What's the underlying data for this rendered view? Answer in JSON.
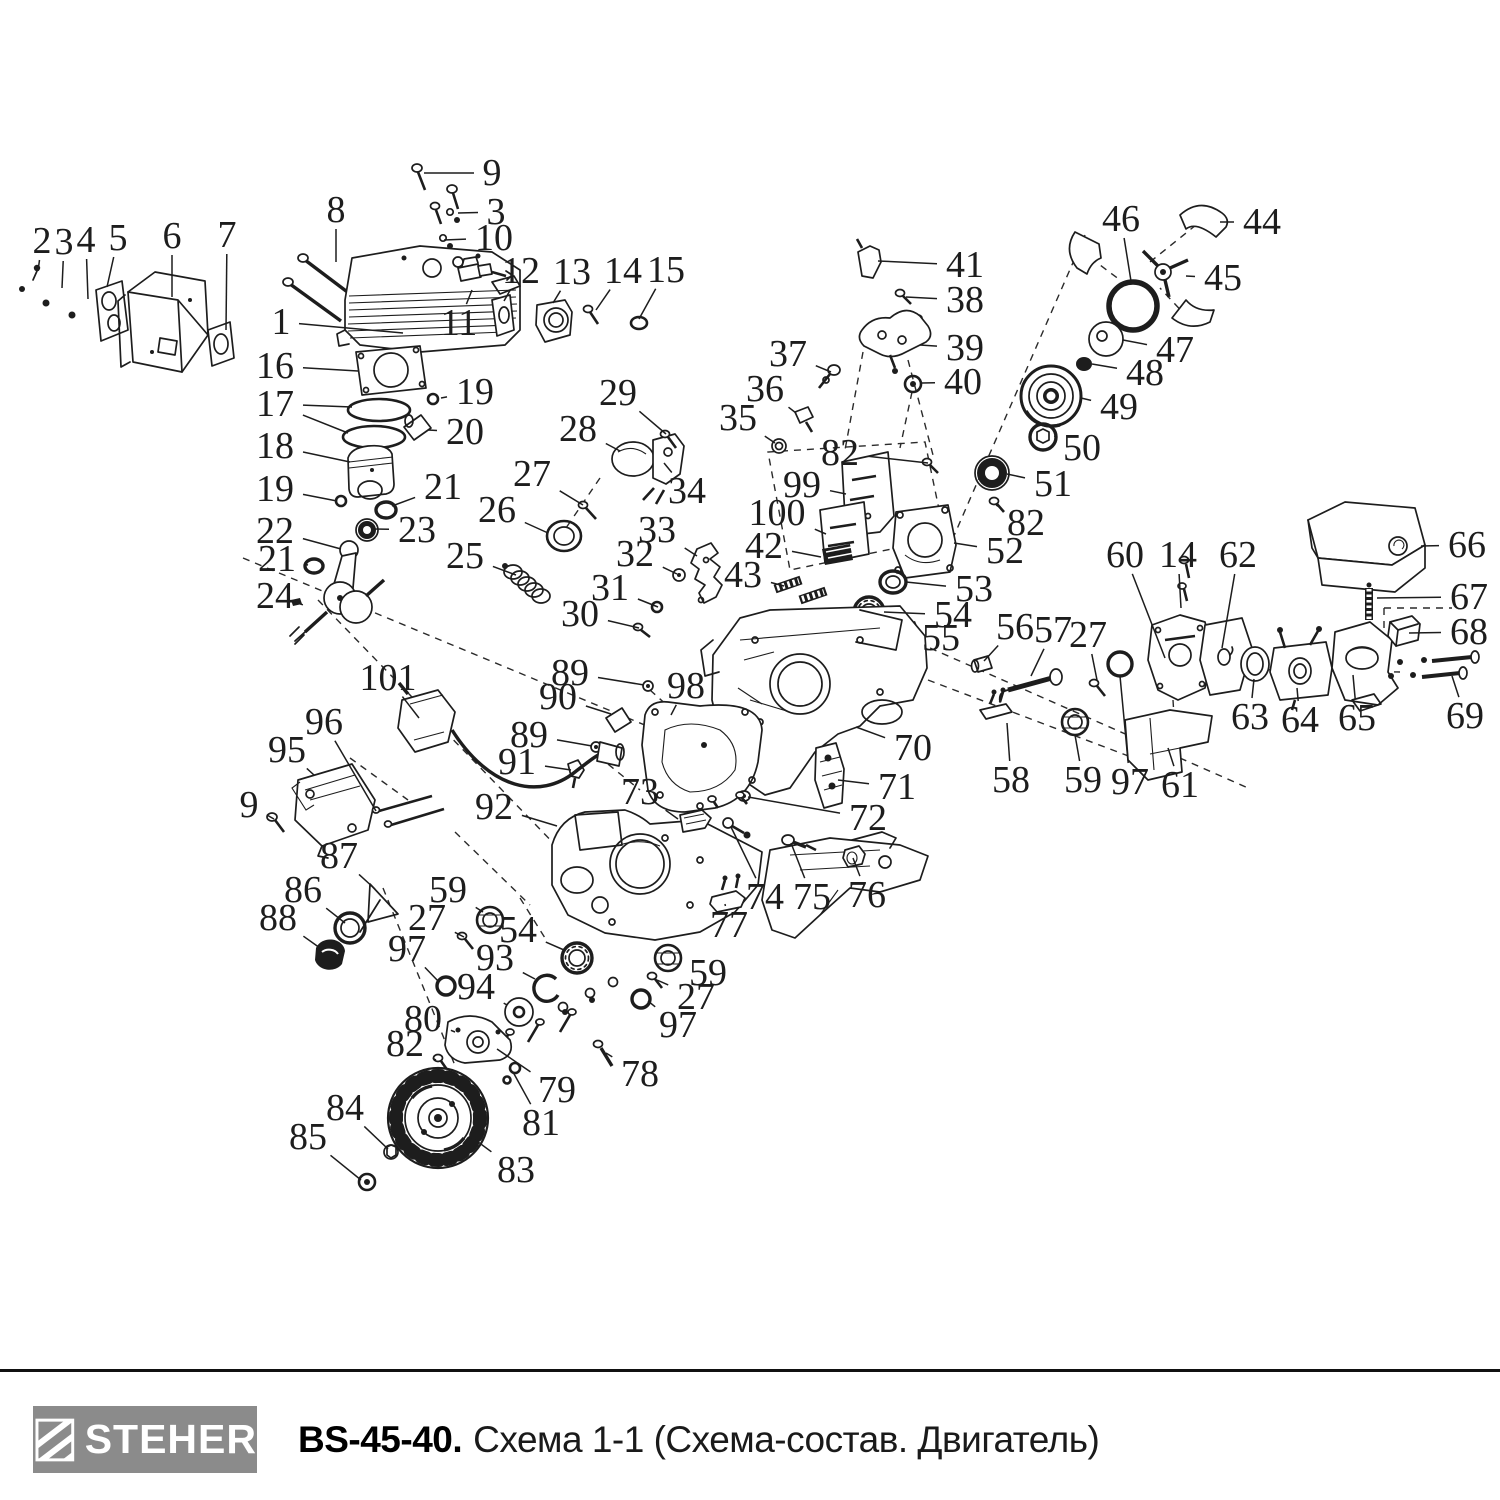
{
  "footer": {
    "brand": "STEHER",
    "model": "BS-45-40.",
    "title": "Схема 1-1 (Схема-состав. Двигатель)"
  },
  "colors": {
    "ink": "#1d1d1d",
    "dash": "#2a2a2a",
    "logo_bg": "#8b8b8b",
    "logo_text": "#ffffff"
  },
  "callouts": [
    {
      "n": "2",
      "x": 42,
      "y": 241,
      "t": [
        [
          38,
          271
        ]
      ]
    },
    {
      "n": "3",
      "x": 64,
      "y": 242,
      "t": [
        [
          62,
          288
        ]
      ]
    },
    {
      "n": "4",
      "x": 86,
      "y": 240,
      "t": [
        [
          88,
          299
        ]
      ]
    },
    {
      "n": "5",
      "x": 118,
      "y": 238,
      "t": [
        [
          107,
          287
        ]
      ]
    },
    {
      "n": "6",
      "x": 172,
      "y": 236,
      "t": [
        [
          172,
          297
        ]
      ]
    },
    {
      "n": "7",
      "x": 227,
      "y": 235,
      "t": [
        [
          226,
          330
        ]
      ]
    },
    {
      "n": "8",
      "x": 336,
      "y": 210,
      "t": [
        [
          336,
          262
        ]
      ]
    },
    {
      "n": "9",
      "x": 492,
      "y": 173,
      "t": [
        [
          424,
          173
        ]
      ]
    },
    {
      "n": "3",
      "x": 496,
      "y": 212,
      "t": [
        [
          458,
          213
        ]
      ]
    },
    {
      "n": "10",
      "x": 494,
      "y": 238,
      "t": [
        [
          444,
          240
        ]
      ]
    },
    {
      "n": "1",
      "x": 281,
      "y": 322,
      "t": [
        [
          403,
          333
        ]
      ]
    },
    {
      "n": "11",
      "x": 459,
      "y": 323,
      "t": [
        [
          472,
          290
        ]
      ]
    },
    {
      "n": "12",
      "x": 521,
      "y": 271,
      "t": [
        [
          504,
          301
        ]
      ]
    },
    {
      "n": "13",
      "x": 572,
      "y": 272,
      "t": [
        [
          553,
          303
        ]
      ]
    },
    {
      "n": "14",
      "x": 623,
      "y": 271,
      "t": [
        [
          596,
          310
        ]
      ]
    },
    {
      "n": "15",
      "x": 666,
      "y": 270,
      "t": [
        [
          639,
          319
        ]
      ]
    },
    {
      "n": "16",
      "x": 275,
      "y": 366,
      "t": [
        [
          358,
          371
        ]
      ]
    },
    {
      "n": "17",
      "x": 275,
      "y": 404,
      "t": [
        [
          352,
          407
        ],
        [
          348,
          433
        ]
      ]
    },
    {
      "n": "19",
      "x": 475,
      "y": 392,
      "t": [
        [
          441,
          398
        ]
      ]
    },
    {
      "n": "20",
      "x": 465,
      "y": 432,
      "t": [
        [
          428,
          430
        ]
      ]
    },
    {
      "n": "18",
      "x": 275,
      "y": 446,
      "t": [
        [
          350,
          462
        ]
      ]
    },
    {
      "n": "19",
      "x": 275,
      "y": 489,
      "t": [
        [
          337,
          501
        ]
      ]
    },
    {
      "n": "21",
      "x": 443,
      "y": 487,
      "t": [
        [
          392,
          506
        ]
      ]
    },
    {
      "n": "22",
      "x": 275,
      "y": 531,
      "t": [
        [
          341,
          549
        ]
      ]
    },
    {
      "n": "23",
      "x": 417,
      "y": 530,
      "t": [
        [
          374,
          529
        ]
      ]
    },
    {
      "n": "21",
      "x": 277,
      "y": 559,
      "t": [
        [
          308,
          565
        ]
      ]
    },
    {
      "n": "24",
      "x": 275,
      "y": 596,
      "t": [
        [
          294,
          602
        ]
      ]
    },
    {
      "n": "25",
      "x": 465,
      "y": 556,
      "t": [
        [
          516,
          575
        ]
      ]
    },
    {
      "n": "26",
      "x": 497,
      "y": 510,
      "t": [
        [
          548,
          533
        ]
      ]
    },
    {
      "n": "27",
      "x": 532,
      "y": 474,
      "t": [
        [
          583,
          505
        ]
      ]
    },
    {
      "n": "28",
      "x": 578,
      "y": 429,
      "t": [
        [
          620,
          451
        ]
      ]
    },
    {
      "n": "29",
      "x": 618,
      "y": 393,
      "t": [
        [
          666,
          434
        ]
      ]
    },
    {
      "n": "30",
      "x": 580,
      "y": 614,
      "t": [
        [
          639,
          628
        ]
      ]
    },
    {
      "n": "31",
      "x": 610,
      "y": 588,
      "t": [
        [
          658,
          607
        ]
      ]
    },
    {
      "n": "32",
      "x": 635,
      "y": 554,
      "t": [
        [
          677,
          574
        ]
      ]
    },
    {
      "n": "33",
      "x": 657,
      "y": 530,
      "t": [
        [
          697,
          556
        ]
      ]
    },
    {
      "n": "34",
      "x": 687,
      "y": 491,
      "t": [
        [
          664,
          463
        ]
      ]
    },
    {
      "n": "35",
      "x": 738,
      "y": 418,
      "t": [
        [
          775,
          443
        ]
      ]
    },
    {
      "n": "36",
      "x": 765,
      "y": 389,
      "t": [
        [
          796,
          413
        ]
      ]
    },
    {
      "n": "37",
      "x": 788,
      "y": 354,
      "t": [
        [
          831,
          372
        ]
      ]
    },
    {
      "n": "38",
      "x": 965,
      "y": 300,
      "t": [
        [
          906,
          297
        ]
      ]
    },
    {
      "n": "39",
      "x": 965,
      "y": 348,
      "t": [
        [
          920,
          345
        ]
      ]
    },
    {
      "n": "40",
      "x": 963,
      "y": 382,
      "t": [
        [
          922,
          383
        ]
      ]
    },
    {
      "n": "41",
      "x": 965,
      "y": 265,
      "t": [
        [
          878,
          261
        ]
      ]
    },
    {
      "n": "42",
      "x": 764,
      "y": 546,
      "t": [
        [
          821,
          557
        ]
      ]
    },
    {
      "n": "43",
      "x": 743,
      "y": 575,
      "t": [
        [
          784,
          586
        ]
      ]
    },
    {
      "n": "44",
      "x": 1262,
      "y": 222,
      "t": [
        [
          1220,
          222
        ]
      ]
    },
    {
      "n": "45",
      "x": 1223,
      "y": 278,
      "t": [
        [
          1186,
          276
        ]
      ]
    },
    {
      "n": "46",
      "x": 1121,
      "y": 219,
      "t": [
        [
          1131,
          281
        ]
      ]
    },
    {
      "n": "47",
      "x": 1175,
      "y": 350,
      "t": [
        [
          1123,
          340
        ]
      ]
    },
    {
      "n": "48",
      "x": 1145,
      "y": 373,
      "t": [
        [
          1092,
          364
        ]
      ]
    },
    {
      "n": "49",
      "x": 1119,
      "y": 407,
      "t": [
        [
          1081,
          398
        ]
      ]
    },
    {
      "n": "50",
      "x": 1082,
      "y": 448,
      "t": [
        [
          1056,
          437
        ]
      ]
    },
    {
      "n": "51",
      "x": 1053,
      "y": 484,
      "t": [
        [
          1007,
          474
        ]
      ]
    },
    {
      "n": "52",
      "x": 1005,
      "y": 551,
      "t": [
        [
          954,
          543
        ]
      ]
    },
    {
      "n": "53",
      "x": 974,
      "y": 589,
      "t": [
        [
          906,
          582
        ]
      ]
    },
    {
      "n": "54",
      "x": 953,
      "y": 615,
      "t": [
        [
          884,
          612
        ]
      ]
    },
    {
      "n": "55",
      "x": 941,
      "y": 638,
      "t": [
        [
          913,
          632
        ]
      ]
    },
    {
      "n": "56",
      "x": 1015,
      "y": 627,
      "t": [
        [
          984,
          661
        ]
      ]
    },
    {
      "n": "57",
      "x": 1053,
      "y": 630,
      "t": [
        [
          1031,
          676
        ]
      ]
    },
    {
      "n": "27",
      "x": 1088,
      "y": 635,
      "t": [
        [
          1097,
          680
        ]
      ]
    },
    {
      "n": "58",
      "x": 1011,
      "y": 780,
      "t": [
        [
          1007,
          723
        ]
      ]
    },
    {
      "n": "59",
      "x": 1083,
      "y": 780,
      "t": [
        [
          1075,
          735
        ]
      ]
    },
    {
      "n": "97",
      "x": 1130,
      "y": 782,
      "t": [
        [
          1120,
          676
        ]
      ]
    },
    {
      "n": "60",
      "x": 1125,
      "y": 555,
      "t": [
        [
          1165,
          658
        ]
      ]
    },
    {
      "n": "14",
      "x": 1178,
      "y": 555,
      "t": [
        [
          1181,
          608
        ]
      ]
    },
    {
      "n": "62",
      "x": 1238,
      "y": 555,
      "t": [
        [
          1222,
          648
        ]
      ]
    },
    {
      "n": "61",
      "x": 1180,
      "y": 785,
      "t": [
        [
          1168,
          748
        ]
      ]
    },
    {
      "n": "63",
      "x": 1250,
      "y": 717,
      "t": [
        [
          1254,
          679
        ]
      ]
    },
    {
      "n": "64",
      "x": 1300,
      "y": 720,
      "t": [
        [
          1297,
          688
        ]
      ]
    },
    {
      "n": "65",
      "x": 1357,
      "y": 718,
      "t": [
        [
          1353,
          675
        ]
      ]
    },
    {
      "n": "66",
      "x": 1467,
      "y": 545,
      "t": [
        [
          1421,
          546
        ]
      ]
    },
    {
      "n": "67",
      "x": 1469,
      "y": 597,
      "t": [
        [
          1377,
          598
        ]
      ]
    },
    {
      "n": "68",
      "x": 1469,
      "y": 632,
      "t": [
        [
          1409,
          633
        ]
      ]
    },
    {
      "n": "69",
      "x": 1465,
      "y": 716,
      "t": [
        [
          1452,
          676
        ]
      ]
    },
    {
      "n": "70",
      "x": 913,
      "y": 748,
      "t": [
        [
          856,
          727
        ]
      ]
    },
    {
      "n": "71",
      "x": 897,
      "y": 787,
      "t": [
        [
          838,
          780
        ]
      ]
    },
    {
      "n": "72",
      "x": 868,
      "y": 818,
      "t": [
        [
          748,
          797
        ]
      ]
    },
    {
      "n": "73",
      "x": 640,
      "y": 792,
      "t": [
        [
          678,
          819
        ]
      ]
    },
    {
      "n": "74",
      "x": 765,
      "y": 897,
      "t": [
        [
          731,
          827
        ]
      ]
    },
    {
      "n": "75",
      "x": 812,
      "y": 897,
      "t": [
        [
          791,
          843
        ]
      ]
    },
    {
      "n": "76",
      "x": 867,
      "y": 895,
      "t": [
        [
          853,
          858
        ]
      ]
    },
    {
      "n": "77",
      "x": 729,
      "y": 925,
      "t": [
        [
          725,
          904
        ]
      ]
    },
    {
      "n": "78",
      "x": 640,
      "y": 1074,
      "t": [
        [
          606,
          1053
        ]
      ]
    },
    {
      "n": "79",
      "x": 557,
      "y": 1090,
      "t": [
        [
          497,
          1049
        ]
      ]
    },
    {
      "n": "80",
      "x": 423,
      "y": 1019,
      "t": [
        [
          455,
          1032
        ]
      ]
    },
    {
      "n": "81",
      "x": 541,
      "y": 1123,
      "t": [
        [
          513,
          1072
        ]
      ]
    },
    {
      "n": "82",
      "x": 405,
      "y": 1044,
      "t": [
        [
          436,
          1060
        ]
      ]
    },
    {
      "n": "83",
      "x": 516,
      "y": 1170,
      "t": [
        [
          470,
          1136
        ]
      ]
    },
    {
      "n": "84",
      "x": 345,
      "y": 1108,
      "t": [
        [
          388,
          1149
        ]
      ]
    },
    {
      "n": "85",
      "x": 308,
      "y": 1137,
      "t": [
        [
          361,
          1180
        ]
      ]
    },
    {
      "n": "86",
      "x": 303,
      "y": 890,
      "t": [
        [
          345,
          923
        ]
      ]
    },
    {
      "n": "87",
      "x": 339,
      "y": 856,
      "t": [
        [
          375,
          889
        ]
      ]
    },
    {
      "n": "88",
      "x": 278,
      "y": 918,
      "t": [
        [
          320,
          948
        ]
      ]
    },
    {
      "n": "89",
      "x": 570,
      "y": 673,
      "t": [
        [
          644,
          685
        ]
      ]
    },
    {
      "n": "90",
      "x": 558,
      "y": 697,
      "t": [
        [
          611,
          714
        ]
      ]
    },
    {
      "n": "89",
      "x": 529,
      "y": 735,
      "t": [
        [
          592,
          746
        ]
      ]
    },
    {
      "n": "91",
      "x": 517,
      "y": 762,
      "t": [
        [
          571,
          770
        ]
      ]
    },
    {
      "n": "92",
      "x": 494,
      "y": 807,
      "t": [
        [
          557,
          826
        ]
      ]
    },
    {
      "n": "93",
      "x": 495,
      "y": 958,
      "t": [
        [
          535,
          979
        ]
      ]
    },
    {
      "n": "94",
      "x": 476,
      "y": 987,
      "t": [
        [
          507,
          1005
        ]
      ]
    },
    {
      "n": "95",
      "x": 287,
      "y": 750,
      "t": [
        [
          314,
          775
        ]
      ]
    },
    {
      "n": "96",
      "x": 324,
      "y": 722,
      "t": [
        [
          376,
          811
        ]
      ]
    },
    {
      "n": "97",
      "x": 407,
      "y": 949,
      "t": [
        [
          439,
          982
        ]
      ]
    },
    {
      "n": "98",
      "x": 686,
      "y": 686,
      "t": [
        [
          671,
          715
        ]
      ]
    },
    {
      "n": "99",
      "x": 802,
      "y": 485,
      "t": [
        [
          846,
          494
        ]
      ]
    },
    {
      "n": "100",
      "x": 777,
      "y": 513,
      "t": [
        [
          826,
          534
        ]
      ]
    },
    {
      "n": "101",
      "x": 388,
      "y": 678,
      "t": [
        [
          419,
          718
        ]
      ]
    },
    {
      "n": "9",
      "x": 249,
      "y": 805,
      "t": [
        [
          274,
          819
        ]
      ]
    },
    {
      "n": "27",
      "x": 427,
      "y": 918,
      "t": [
        [
          464,
          937
        ]
      ]
    },
    {
      "n": "54",
      "x": 518,
      "y": 930,
      "t": [
        [
          564,
          950
        ]
      ]
    },
    {
      "n": "59",
      "x": 448,
      "y": 890,
      "t": [
        [
          483,
          912
        ]
      ]
    },
    {
      "n": "27",
      "x": 696,
      "y": 997,
      "t": [
        [
          657,
          980
        ]
      ]
    },
    {
      "n": "59",
      "x": 708,
      "y": 973,
      "t": [
        [
          681,
          960
        ]
      ]
    },
    {
      "n": "97",
      "x": 678,
      "y": 1025,
      "t": [
        [
          648,
          1001
        ]
      ]
    },
    {
      "n": "82",
      "x": 840,
      "y": 453,
      "t": [
        [
          928,
          463
        ]
      ]
    },
    {
      "n": "82",
      "x": 1026,
      "y": 523,
      "t": [
        [
          996,
          505
        ]
      ]
    }
  ]
}
